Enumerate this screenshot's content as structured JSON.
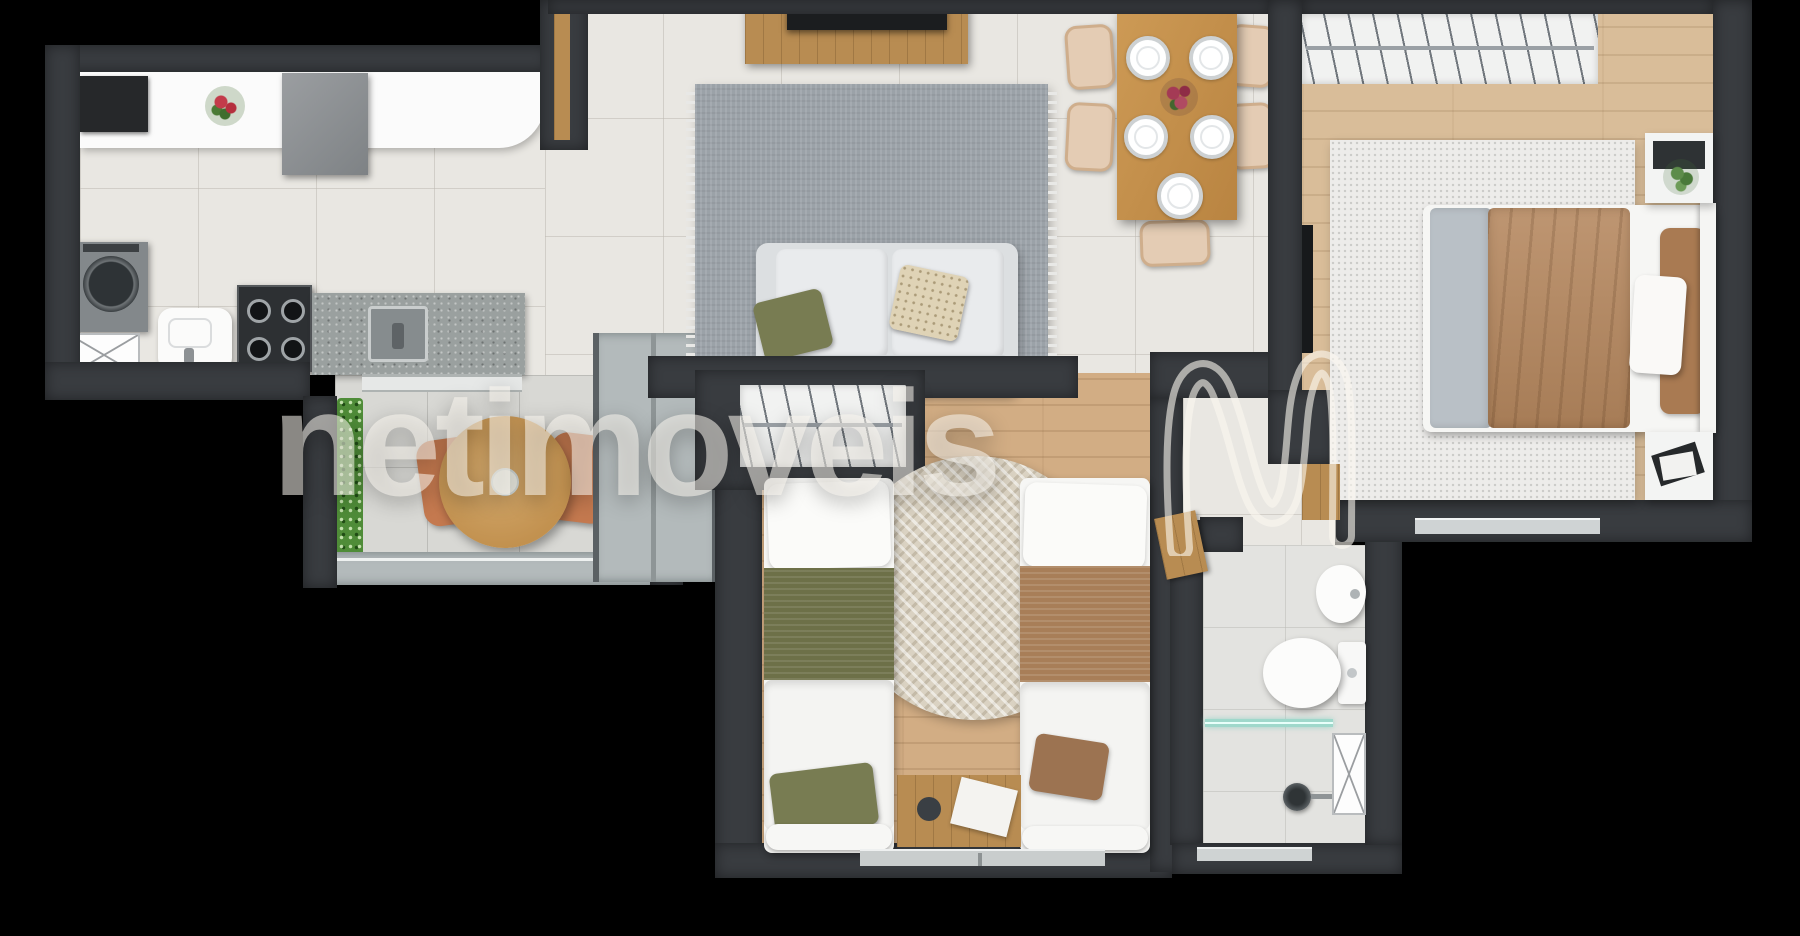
{
  "watermark": {
    "text": "netimoveis",
    "logo": "ribbon-n-outline"
  },
  "palette": {
    "background": "#000000",
    "wall": "#393c40",
    "indoor_tile": "#e9e7e2",
    "balcony_tile": "#d8d8d4",
    "master_wood": "#d9bd99",
    "kids_wood": "#d2ad84",
    "granite_counter": "#9aa09f",
    "living_rug": "#9ba2a8",
    "hedge_green": "#4f8c38",
    "dining_wood": "#c08b47",
    "duvet_camel": "#b5875e",
    "blanket_olive": "#6d7048",
    "blanket_brown": "#a87e58",
    "shower_glass": "#9fd8cb",
    "watermark_white": "rgba(252,248,240,0.55)"
  },
  "scene": {
    "type": "apartment-floor-plan-render",
    "dining_plates": 5,
    "dining_chairs": 5,
    "single_beds": 2,
    "double_beds": 1
  }
}
